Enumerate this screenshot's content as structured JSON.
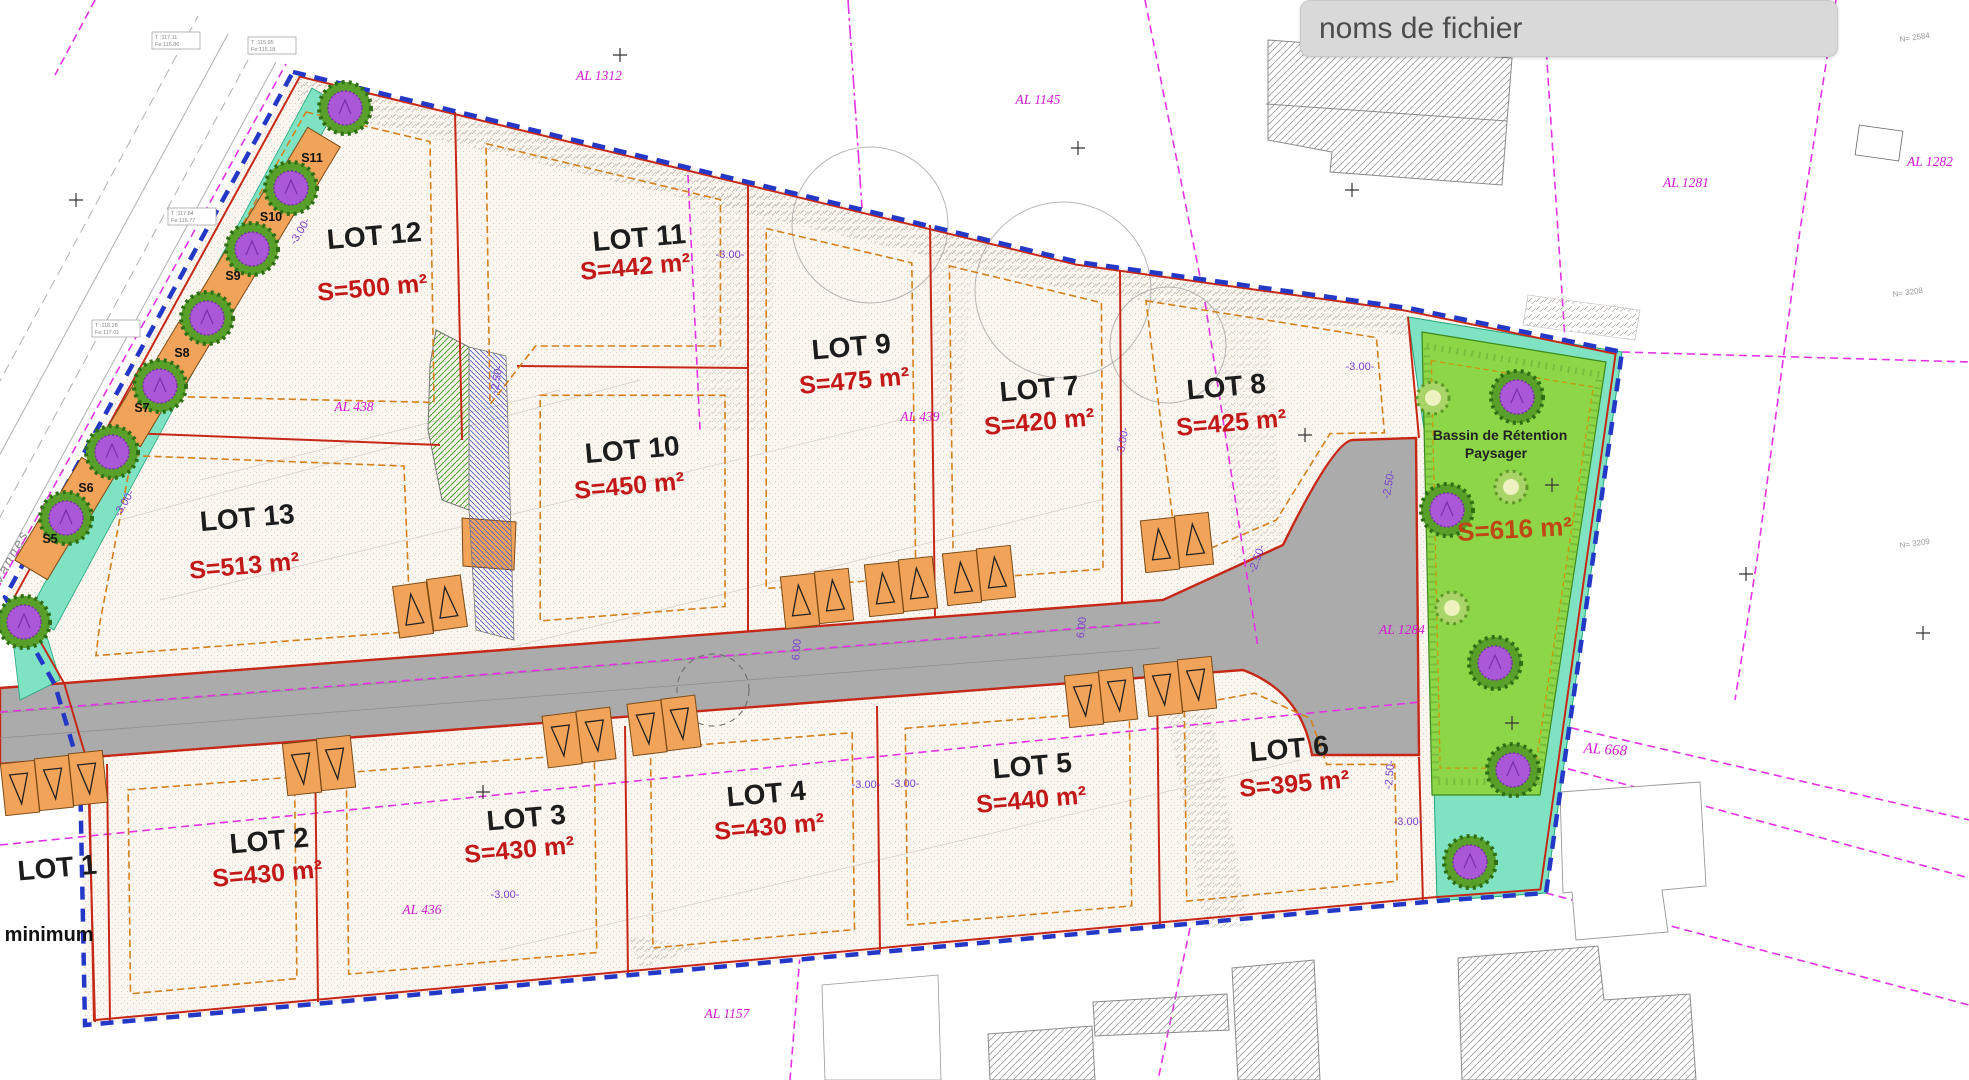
{
  "header": {
    "filename_label": "noms de fichier"
  },
  "plan": {
    "street_name": "Rue de Vannes",
    "lots": [
      {
        "label": "LOT 1",
        "area": "",
        "note": "s minimum"
      },
      {
        "label": "LOT 2",
        "area": "S=430 m²"
      },
      {
        "label": "LOT 3",
        "area": "S=430 m²"
      },
      {
        "label": "LOT 4",
        "area": "S=430 m²"
      },
      {
        "label": "LOT 5",
        "area": "S=440 m²"
      },
      {
        "label": "LOT 6",
        "area": "S=395 m²"
      },
      {
        "label": "LOT 7",
        "area": "S=420 m²"
      },
      {
        "label": "LOT 8",
        "area": "S=425 m²"
      },
      {
        "label": "LOT 9",
        "area": "S=475 m²"
      },
      {
        "label": "LOT 10",
        "area": "S=450 m²"
      },
      {
        "label": "LOT 11",
        "area": "S=442 m²"
      },
      {
        "label": "LOT 12",
        "area": "S=500 m²"
      },
      {
        "label": "LOT 13",
        "area": "S=513 m²"
      }
    ],
    "basin": {
      "title_line1": "Bassin de Rétention",
      "title_line2": "Paysager",
      "area": "S=616 m²"
    },
    "parcel_refs": [
      "AL 1312",
      "AL 1145",
      "AL 1281",
      "AL 1282",
      "AL 438",
      "AL 439",
      "AL 1284",
      "AL 668",
      "AL 436",
      "AL 1157"
    ],
    "parking_spots": [
      "S5",
      "S6",
      "S7",
      "S8",
      "S9",
      "S10",
      "S11"
    ],
    "dimensions": [
      "-3.00-",
      "-3.00-",
      "-3.00-",
      "-3.00-",
      "-2.50-",
      "-2.50-",
      "-2.50-",
      "-3.00-",
      "6.00",
      "6.00",
      "-3.00-",
      "-3.00-",
      "-3.00-",
      "-3.00-",
      "-2.50-"
    ],
    "survey_points": [
      {
        "line1": "T :117.11",
        "line2": "Fe:116.86"
      },
      {
        "line1": "T :115.95",
        "line2": "Fe:115.18"
      },
      {
        "line1": "T :117.84",
        "line2": "Fe:116.77"
      },
      {
        "line1": "T :118.28",
        "line2": "Fe:117.01"
      }
    ],
    "geodetic_labels": [
      "N= 2584",
      "N= 3208",
      "N= 3209"
    ],
    "colors": {
      "boundary_blue": "#2438c8",
      "lot_line_red": "#c62818",
      "parcel_magenta": "#d018d0",
      "setback_orange": "#d4801c",
      "road_gray": "#ababab",
      "basin_green": "#8cd648",
      "verge_aqua": "#7fe3c3",
      "stall_orange": "#f2a35a",
      "area_red": "#c21818"
    }
  }
}
